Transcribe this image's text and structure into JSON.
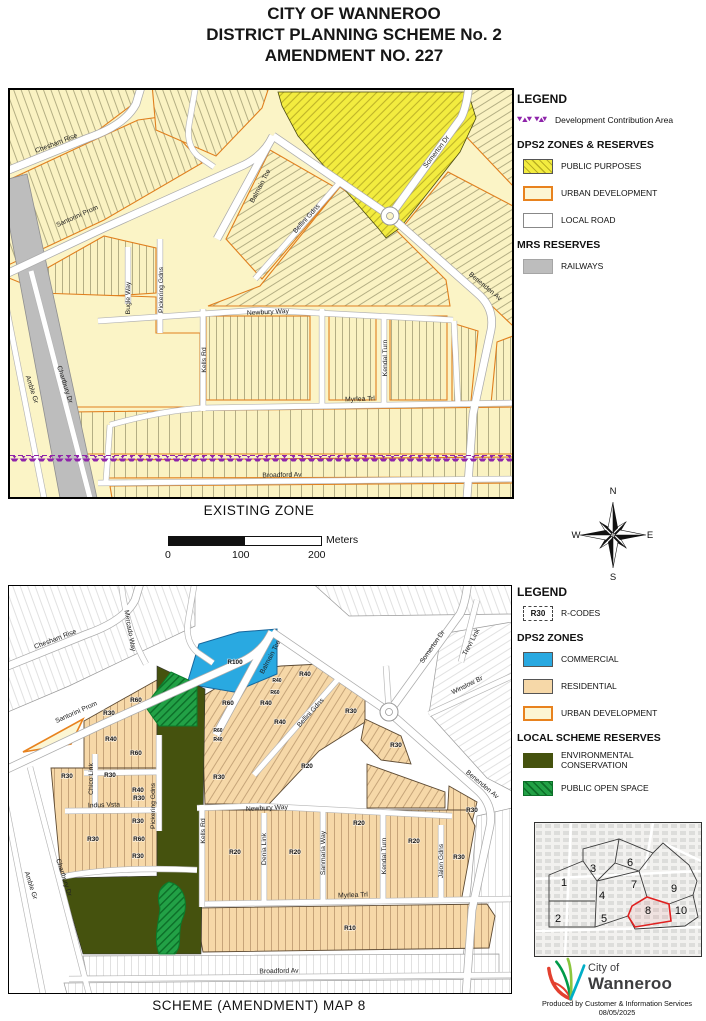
{
  "title": {
    "line1": "CITY OF WANNEROO",
    "line2": "DISTRICT PLANNING SCHEME No. 2",
    "line3": "AMENDMENT NO. 227"
  },
  "top_map": {
    "caption": "EXISTING ZONE",
    "legend": {
      "heading": "LEGEND",
      "dca_label": "Development Contribution Area",
      "zones_heading": "DPS2 ZONES & RESERVES",
      "public_purposes": "PUBLIC PURPOSES",
      "urban_development": "URBAN DEVELOPMENT",
      "local_road": "LOCAL ROAD",
      "mrs_heading": "MRS RESERVES",
      "railways": "RAILWAYS"
    },
    "streets": [
      {
        "name": "Chesham Rise",
        "x": 47,
        "y": 55,
        "rot": -21
      },
      {
        "name": "Santorini Prom",
        "x": 68,
        "y": 128,
        "rot": -24
      },
      {
        "name": "Balmain Tce",
        "x": 252,
        "y": 97,
        "rot": -62
      },
      {
        "name": "Bellini Gdns",
        "x": 298,
        "y": 130,
        "rot": -48
      },
      {
        "name": "Somerton Dr",
        "x": 428,
        "y": 63,
        "rot": -53
      },
      {
        "name": "Benenden Av",
        "x": 474,
        "y": 198,
        "rot": 40
      },
      {
        "name": "Newbury Way",
        "x": 258,
        "y": 224,
        "rot": -3
      },
      {
        "name": "Kells Rd",
        "x": 196,
        "y": 270,
        "rot": -90
      },
      {
        "name": "Kendal Turn",
        "x": 377,
        "y": 268,
        "rot": -90
      },
      {
        "name": "Pickering Gdns",
        "x": 153,
        "y": 200,
        "rot": -90
      },
      {
        "name": "Bugle Way",
        "x": 120,
        "y": 208,
        "rot": -90
      },
      {
        "name": "Myrlea Trl",
        "x": 350,
        "y": 311,
        "rot": -2
      },
      {
        "name": "Broadford Av",
        "x": 272,
        "y": 387,
        "rot": -1
      },
      {
        "name": "Chartbury Dr",
        "x": 53,
        "y": 295,
        "rot": 72
      },
      {
        "name": "Amble Gr",
        "x": 20,
        "y": 300,
        "rot": 72
      }
    ]
  },
  "scalebar": {
    "tick0": "0",
    "tick1": "100",
    "tick2": "200",
    "unit": "Meters"
  },
  "compass": {
    "n": "N",
    "e": "E",
    "s": "S",
    "w": "W"
  },
  "bottom_map": {
    "caption": "SCHEME (AMENDMENT) MAP 8",
    "legend": {
      "heading": "LEGEND",
      "rcodes_swatch": "R30",
      "rcodes_label": "R-CODES",
      "zones_heading": "DPS2 ZONES",
      "commercial": "COMMERCIAL",
      "residential": "RESIDENTIAL",
      "urban_development": "URBAN DEVELOPMENT",
      "reserves_heading": "LOCAL SCHEME RESERVES",
      "environmental": "ENVIRONMENTAL CONSERVATION",
      "open_space": "PUBLIC OPEN SPACE"
    },
    "streets": [
      {
        "name": "Chesham Rise",
        "x": 47,
        "y": 55,
        "rot": -21
      },
      {
        "name": "Mercado Way",
        "x": 119,
        "y": 45,
        "rot": 80
      },
      {
        "name": "Santorini Prom",
        "x": 68,
        "y": 128,
        "rot": -24
      },
      {
        "name": "Balmain Tce",
        "x": 263,
        "y": 72,
        "rot": -62
      },
      {
        "name": "Bellini Gdns",
        "x": 303,
        "y": 128,
        "rot": -48
      },
      {
        "name": "Somerton Dr",
        "x": 425,
        "y": 62,
        "rot": -55
      },
      {
        "name": "Trevi Link",
        "x": 464,
        "y": 57,
        "rot": -62
      },
      {
        "name": "Winslow Br",
        "x": 459,
        "y": 101,
        "rot": -26
      },
      {
        "name": "Benenden Av",
        "x": 472,
        "y": 200,
        "rot": 40
      },
      {
        "name": "Newbury Way",
        "x": 258,
        "y": 224,
        "rot": -3
      },
      {
        "name": "Kells Rd",
        "x": 196,
        "y": 245,
        "rot": -90
      },
      {
        "name": "Pickering Gdns",
        "x": 146,
        "y": 220,
        "rot": -90
      },
      {
        "name": "Chico Link",
        "x": 84,
        "y": 193,
        "rot": -90
      },
      {
        "name": "Indus Vsta",
        "x": 95,
        "y": 221,
        "rot": -2
      },
      {
        "name": "Denia Link",
        "x": 257,
        "y": 263,
        "rot": -90
      },
      {
        "name": "Sanmaria Way",
        "x": 316,
        "y": 267,
        "rot": -90
      },
      {
        "name": "Kendal Turn",
        "x": 377,
        "y": 270,
        "rot": -90
      },
      {
        "name": "Jalon Gdns",
        "x": 434,
        "y": 275,
        "rot": -90
      },
      {
        "name": "Myrlea Trl",
        "x": 344,
        "y": 311,
        "rot": -2
      },
      {
        "name": "Broadford Av",
        "x": 270,
        "y": 387,
        "rot": -1
      },
      {
        "name": "Chartbury Dr",
        "x": 53,
        "y": 292,
        "rot": 72
      },
      {
        "name": "Amble Gr",
        "x": 20,
        "y": 300,
        "rot": 72
      }
    ],
    "rcodes": [
      {
        "code": "R100",
        "x": 226,
        "y": 78
      },
      {
        "code": "R60",
        "x": 127,
        "y": 116
      },
      {
        "code": "R30",
        "x": 100,
        "y": 129
      },
      {
        "code": "R40",
        "x": 102,
        "y": 155
      },
      {
        "code": "R60",
        "x": 127,
        "y": 169
      },
      {
        "code": "R60",
        "x": 219,
        "y": 119
      },
      {
        "code": "R40",
        "x": 257,
        "y": 119
      },
      {
        "code": "R60",
        "x": 266,
        "y": 108,
        "s": 1
      },
      {
        "code": "R40",
        "x": 268,
        "y": 96,
        "s": 1
      },
      {
        "code": "R40",
        "x": 296,
        "y": 90
      },
      {
        "code": "R40",
        "x": 271,
        "y": 138
      },
      {
        "code": "R60",
        "x": 209,
        "y": 146,
        "s": 1
      },
      {
        "code": "R40",
        "x": 209,
        "y": 155,
        "s": 1
      },
      {
        "code": "R30",
        "x": 342,
        "y": 127
      },
      {
        "code": "R30",
        "x": 387,
        "y": 161
      },
      {
        "code": "R30",
        "x": 58,
        "y": 192
      },
      {
        "code": "R30",
        "x": 101,
        "y": 191
      },
      {
        "code": "R30",
        "x": 210,
        "y": 193
      },
      {
        "code": "R20",
        "x": 298,
        "y": 182
      },
      {
        "code": "R40",
        "x": 129,
        "y": 206
      },
      {
        "code": "R30",
        "x": 130,
        "y": 214
      },
      {
        "code": "R30",
        "x": 129,
        "y": 237
      },
      {
        "code": "R30",
        "x": 84,
        "y": 255
      },
      {
        "code": "R60",
        "x": 130,
        "y": 255
      },
      {
        "code": "R30",
        "x": 129,
        "y": 272
      },
      {
        "code": "R20",
        "x": 226,
        "y": 268
      },
      {
        "code": "R20",
        "x": 286,
        "y": 268
      },
      {
        "code": "R20",
        "x": 350,
        "y": 239
      },
      {
        "code": "R20",
        "x": 405,
        "y": 257
      },
      {
        "code": "R30",
        "x": 463,
        "y": 226
      },
      {
        "code": "R30",
        "x": 450,
        "y": 273
      },
      {
        "code": "R10",
        "x": 341,
        "y": 344
      }
    ]
  },
  "inset": {
    "highlighted_area": "8",
    "areas": [
      {
        "n": "1",
        "x": 29,
        "y": 63
      },
      {
        "n": "2",
        "x": 23,
        "y": 99
      },
      {
        "n": "3",
        "x": 58,
        "y": 49
      },
      {
        "n": "4",
        "x": 67,
        "y": 76
      },
      {
        "n": "5",
        "x": 69,
        "y": 99
      },
      {
        "n": "6",
        "x": 95,
        "y": 43
      },
      {
        "n": "7",
        "x": 99,
        "y": 65
      },
      {
        "n": "8",
        "x": 113,
        "y": 91
      },
      {
        "n": "9",
        "x": 139,
        "y": 69
      },
      {
        "n": "10",
        "x": 146,
        "y": 91
      }
    ]
  },
  "logo": {
    "city": "City of",
    "name": "Wanneroo",
    "credit": "Produced by Customer & Information Services",
    "date": "08/05/2025"
  },
  "colors": {
    "public_purposes": "#F3EC3F",
    "urban_development": "#FCF6D4",
    "urban_border": "#E07F1E",
    "railway": "#BDBDBD",
    "dca_purple": "#8E24AA",
    "commercial": "#29A9E1",
    "residential": "#F6D8A8",
    "environmental_conservation": "#45520E",
    "public_open_space": "#22A146",
    "inset_highlight": "#E02020"
  }
}
